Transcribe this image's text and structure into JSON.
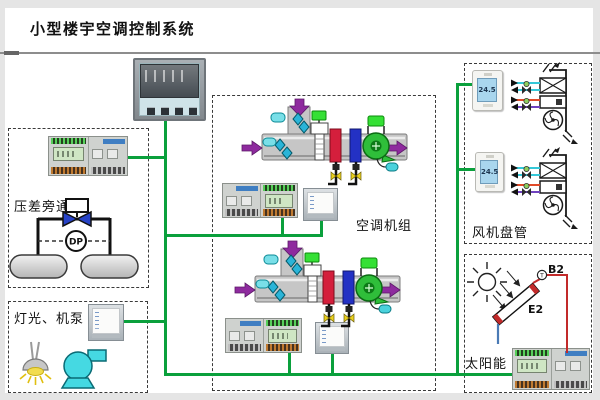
{
  "title": "小型楼宇空调控制系统",
  "sections": {
    "pressure_bypass": {
      "label": "压差旁通",
      "dp_label": "DP"
    },
    "lighting_pumps": {
      "label": "灯光、机泵"
    },
    "air_handling": {
      "label": "空调机组"
    },
    "fan_coil": {
      "label": "风机盘管",
      "thermostat1_value": "24.5",
      "thermostat2_value": "24.5"
    },
    "solar": {
      "label": "太阳能",
      "sensor_label": "B2",
      "sensor_type": "T",
      "collector_label": "E2"
    }
  },
  "colors": {
    "bus_green": "#0aa03c",
    "arrow_purple": "#8e2a9e",
    "heating_coil_red": "#d41f3c",
    "cooling_coil_blue": "#2331c4",
    "fan_green": "#2fbe3a",
    "damper_cyan": "#2ab4d8",
    "pump_cyan": "#45d9e2",
    "thermostat_lcd_blue": "#a9d6ee",
    "controller_lcd_green": "#cfe6c4"
  }
}
